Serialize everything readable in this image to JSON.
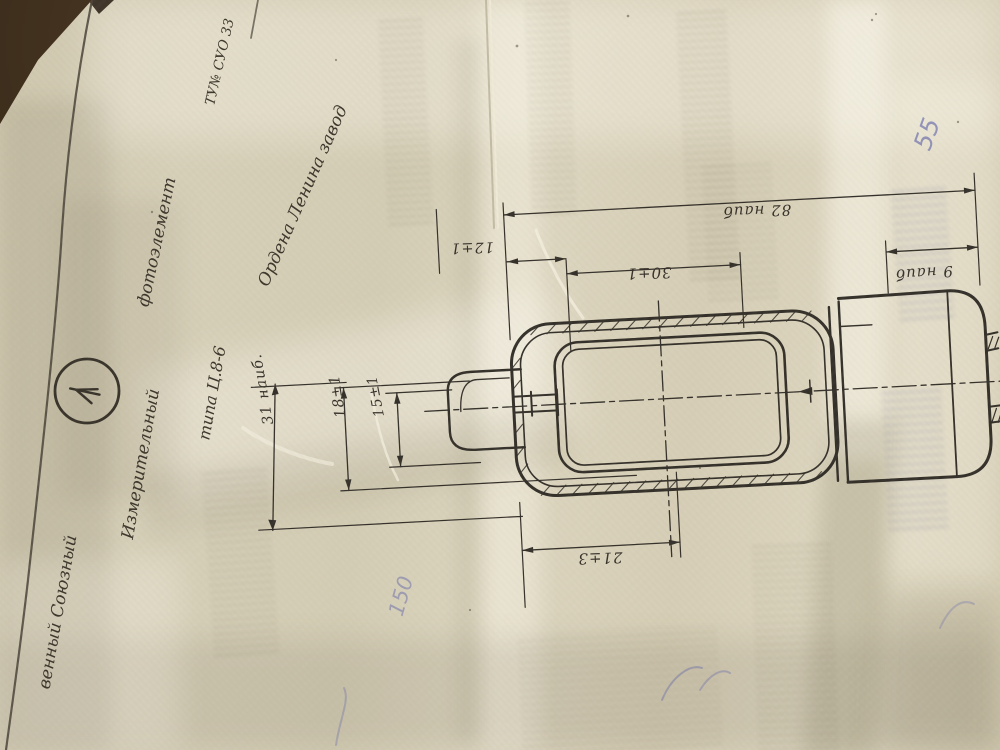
{
  "photo": {
    "description": "Photograph of a folded Soviet photoelement datasheet with a technical drawing, lying on a dark table",
    "paper_color": "#d8d1bb",
    "table_color": "#2c2118",
    "ink_color": "#35302a",
    "blue_ink_color": "#5a5ea8"
  },
  "header": {
    "org_line_partial": "венный Союзный",
    "org_line_2": "Ордена Ленина завод",
    "spec_number": "ТУ№ СУО 33"
  },
  "product": {
    "line_1": "Измерительный",
    "line_2": "фотоэлемент",
    "line_3": "типа Ц.8-6"
  },
  "drawing": {
    "dimensions": {
      "overall_length": "82 наиб",
      "base_length": "9 наиб",
      "window_length": "30±1",
      "edge_offset": "12±1",
      "stem_length": "21±3",
      "connector_height": "18±1",
      "window_height": "15±1",
      "overall_height": "31 наиб."
    }
  },
  "handwritten": {
    "mark_55": "55",
    "mark_150": "150"
  }
}
